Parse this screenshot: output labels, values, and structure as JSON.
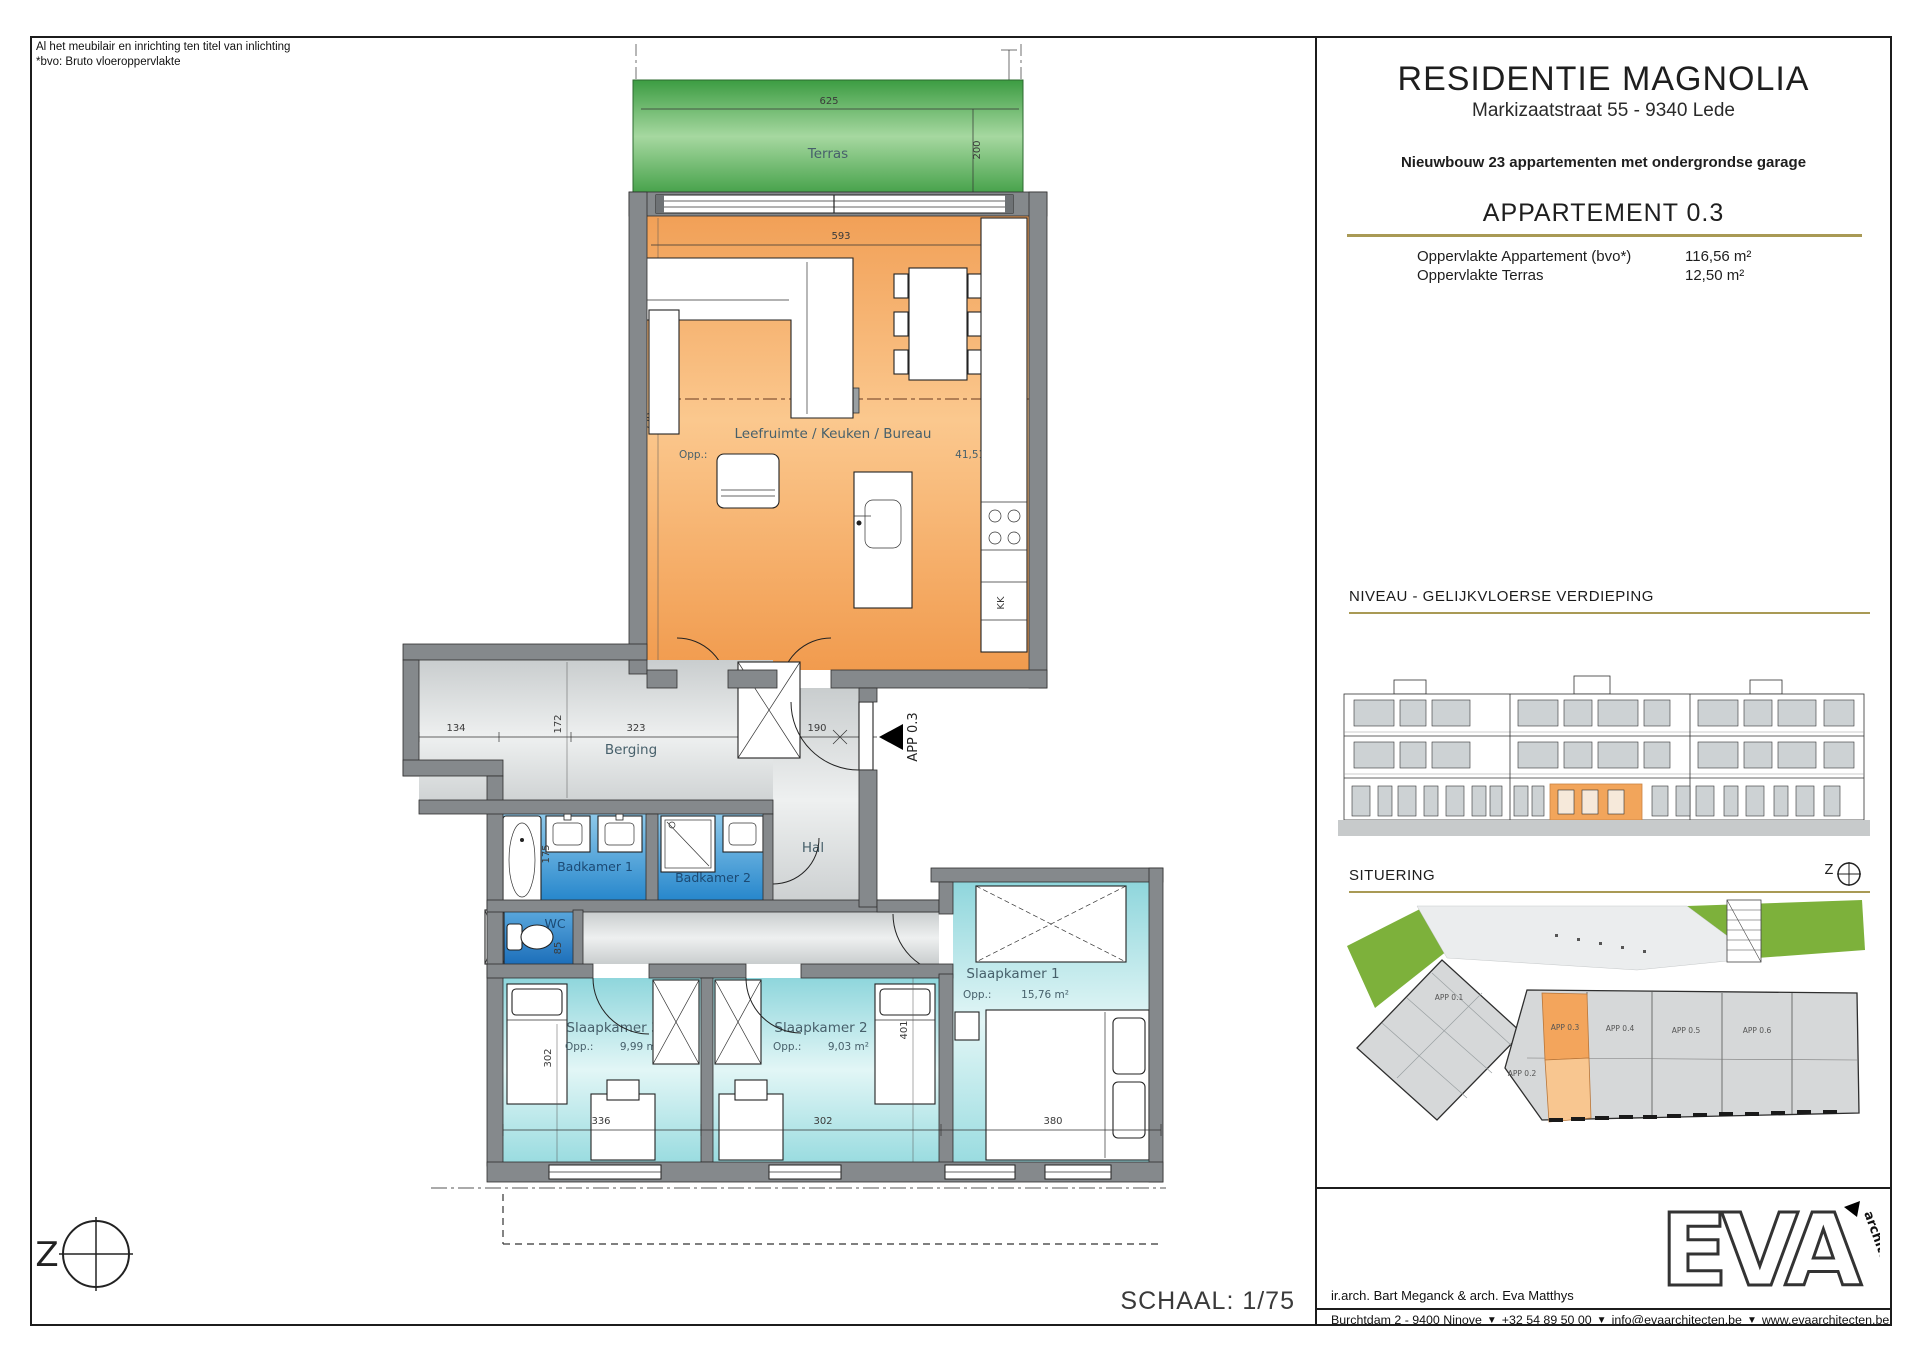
{
  "colors": {
    "gold": "#a99a55",
    "terras_green": "#3c9c42",
    "living_orange": "#f19b4e",
    "bath_blue": "#2787cc",
    "bedroom_cyan": "#8fd6dc",
    "wall_gray": "#85898c"
  },
  "plan": {
    "notes": {
      "line1": "Al het meubilair en inrichting ten titel van inlichting",
      "line2": "*bvo: Bruto vloeroppervlakte"
    },
    "schaal": "SCHAAL: 1/75",
    "compass_letter": "Z",
    "entrance_label": "APP 0.3",
    "rooms": {
      "terras": {
        "name": "Terras",
        "dim_w": "625",
        "dim_h": "200"
      },
      "leefruimte": {
        "name": "Leefruimte / Keuken / Bureau",
        "opp": "Opp.:",
        "area": "41,51 m²",
        "dim_w": "593",
        "dim_h": "730",
        "fridge": "KK"
      },
      "berging": {
        "name": "Berging",
        "dim_w": "323",
        "dim_h": "172",
        "dim_left": "134",
        "dim_door": "190"
      },
      "hal": {
        "name": "Hal"
      },
      "badkamer1": {
        "name": "Badkamer 1",
        "dim_w": "250",
        "dim_h": "175"
      },
      "badkamer2": {
        "name": "Badkamer 2",
        "dim_w": "175"
      },
      "wc": {
        "name": "WC",
        "dim": "85"
      },
      "slaapkamer1": {
        "name": "Slaapkamer 1",
        "opp": "Opp.:",
        "area": "15,76 m²",
        "dim_w": "380",
        "dim_h": "401"
      },
      "slaapkamer2": {
        "name": "Slaapkamer 2",
        "opp": "Opp.:",
        "area": "9,03 m²",
        "dim_w": "302"
      },
      "slaapkamer3": {
        "name": "Slaapkamer 3",
        "opp": "Opp.:",
        "area": "9,99 m²",
        "dim_w": "336",
        "dim_h": "302"
      }
    }
  },
  "title_block": {
    "project": "RESIDENTIE MAGNOLIA",
    "address": "Markizaatstraat 55 - 9340 Lede",
    "subtitle": "Nieuwbouw 23 appartementen met ondergrondse garage",
    "unit": "APPARTEMENT 0.3",
    "specs": [
      {
        "label": "Oppervlakte Appartement (bvo*)",
        "value": "116,56 m²"
      },
      {
        "label": "Oppervlakte Terras",
        "value": "12,50 m²"
      }
    ],
    "niveau_heading": "NIVEAU - GELIJKVLOERSE VERDIEPING",
    "situering": {
      "heading": "SITUERING",
      "compass_letter": "Z",
      "units": [
        "APP 0.1",
        "APP 0.2",
        "APP 0.3",
        "APP 0.4",
        "APP 0.5",
        "APP 0.6"
      ]
    },
    "footer": {
      "architects": "ir.arch. Bart Meganck & arch. Eva Matthys",
      "sep": "▼",
      "contact_parts": [
        "Burchtdam 2 - 9400 Ninove",
        "+32 54 89 50 00",
        "info@evaarchitecten.be",
        "www.evaarchitecten.be"
      ],
      "logo_main": "EVA",
      "logo_sub": "architecten"
    }
  }
}
